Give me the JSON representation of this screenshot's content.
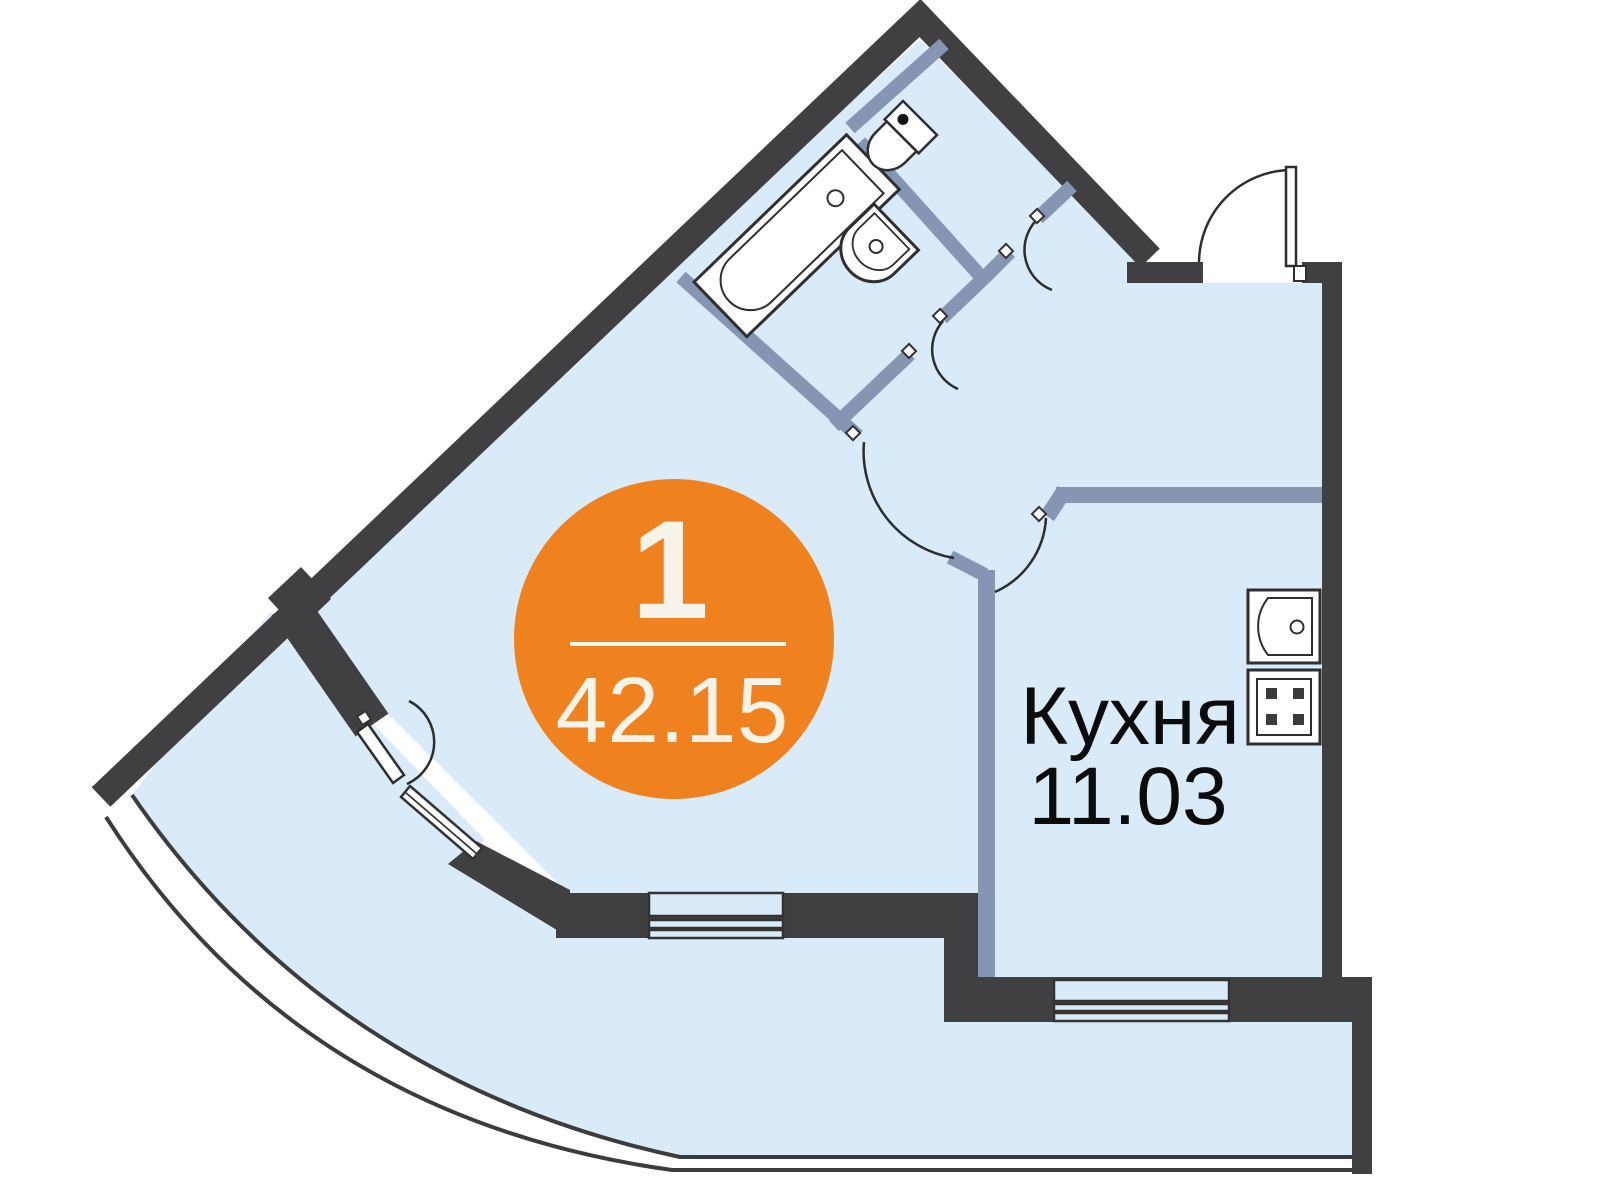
{
  "plan": {
    "badge": {
      "rooms_count": "1",
      "total_area": "42.15"
    },
    "kitchen": {
      "label": "Кухня",
      "area": "11.03"
    },
    "colors": {
      "accent_orange": "#f0811f",
      "wall_dark": "#404042",
      "partition_blue_gray": "#8496b2",
      "floor_light_blue": "#d9eaf8",
      "badge_text": "#f7f3e8",
      "label_text": "#0b0b0b"
    }
  }
}
